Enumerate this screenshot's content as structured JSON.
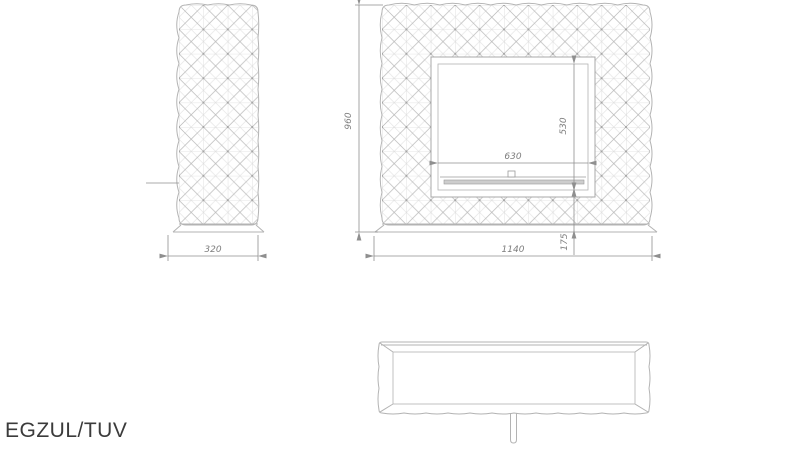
{
  "title": "EGZUL/TUV",
  "colors": {
    "line": "#b3b3b3",
    "dimension_line": "#8f8f8f",
    "dimension_text": "#7d7d7d",
    "title_text": "#3b3b3b",
    "burner_fill": "#cdcdcd",
    "background": "#ffffff"
  },
  "views": {
    "front": {
      "height_dim": "960",
      "width_dim": "1140",
      "opening_width_dim": "630",
      "opening_height_dim": "530",
      "base_height_dim": "175"
    },
    "side": {
      "depth_dim": "320"
    },
    "top": {}
  }
}
